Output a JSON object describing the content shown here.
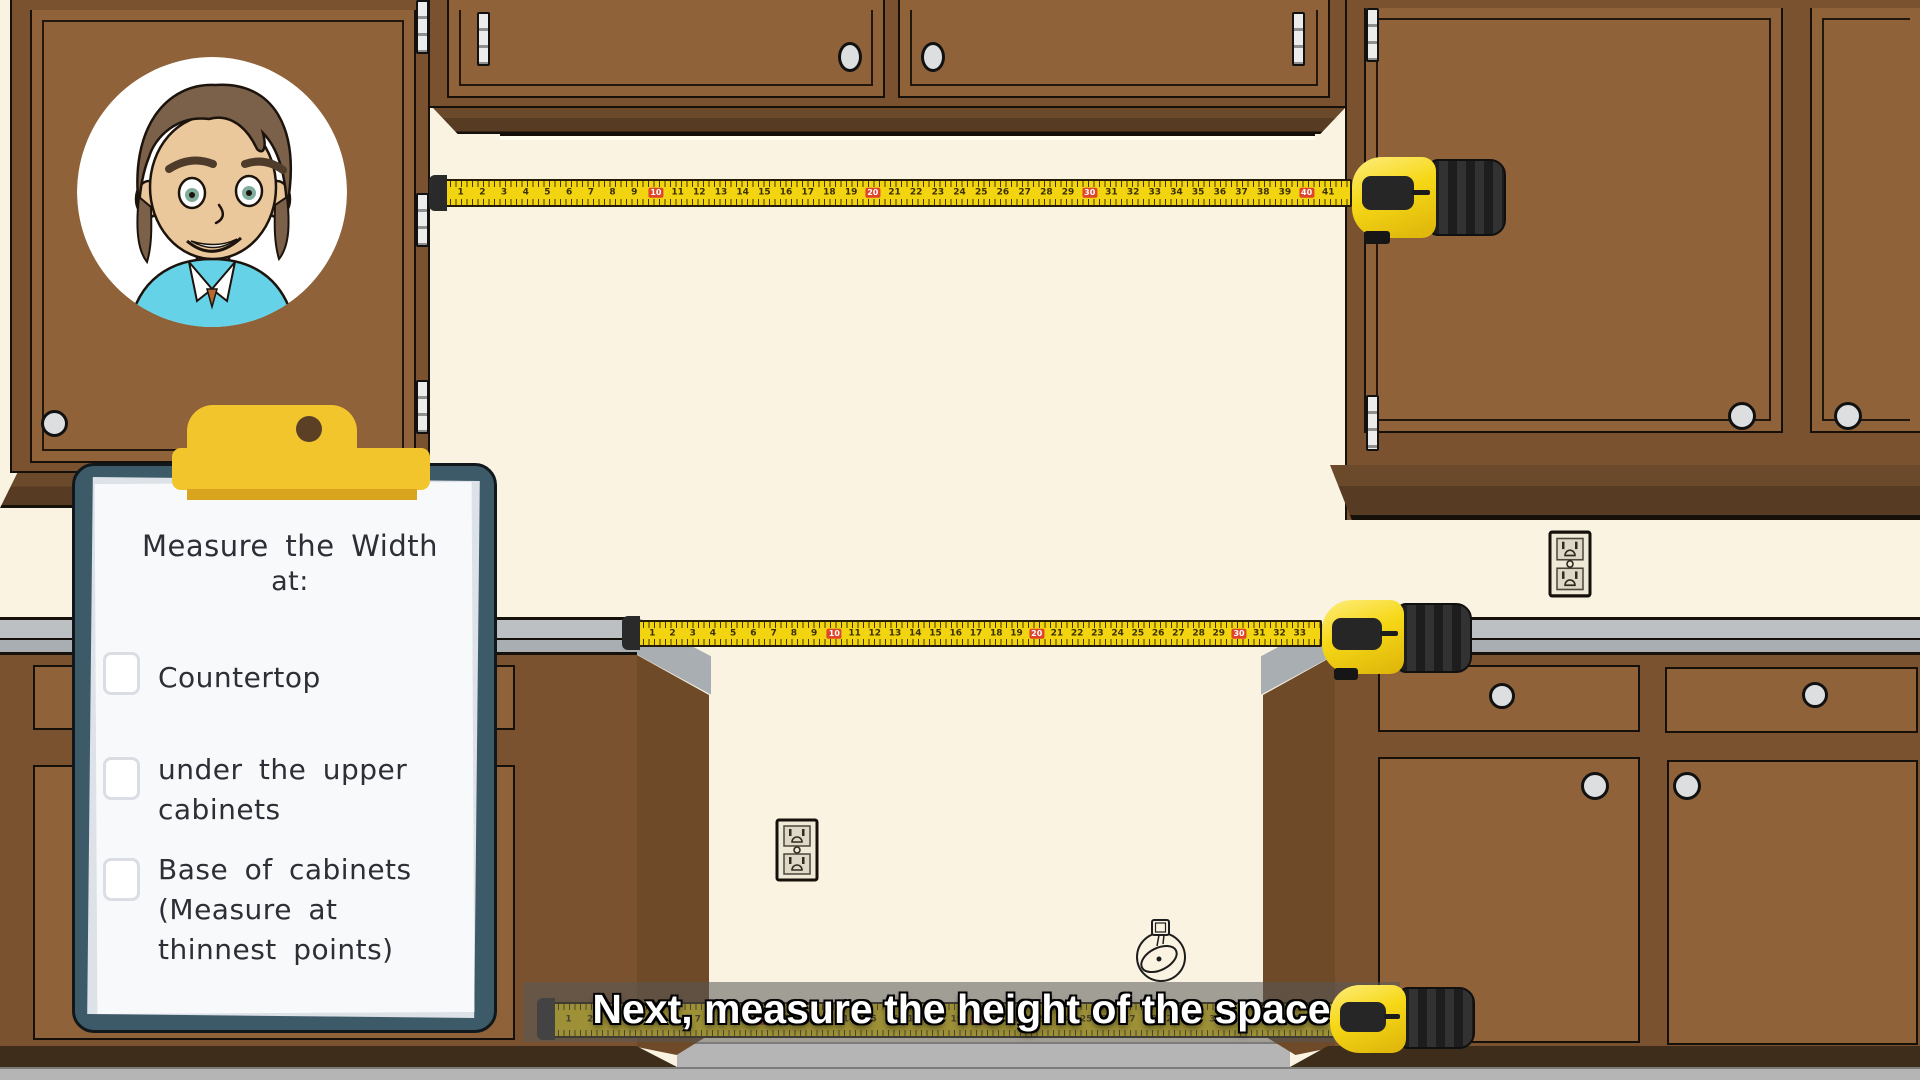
{
  "palette": {
    "wall": "#fbf3e2",
    "face": "#8f6239",
    "frame": "#7a5230",
    "trim1": "#6b4a2b",
    "trim2": "#573b22",
    "toe": "#3f2d1b",
    "ct_light": "#bcc0c3",
    "ct_mid": "#a9aeb2",
    "floor": "#b5b5b5",
    "outline": "#15100a",
    "clip_frame": "#3d5a68",
    "paper": "#f7f9fb",
    "clip_yellow": "#f3c52d",
    "clip_yellow_dark": "#daa51e",
    "tape_yellow": "#f2d411",
    "tape_red": "#e0442a",
    "body_yellow": "#f6d715",
    "body_black": "#262626",
    "ink": "#2e2e36"
  },
  "clipboard": {
    "title_line1": "Measure the Width",
    "title_line2": "at:",
    "items": [
      {
        "label": "Countertop",
        "checked": false
      },
      {
        "label": "under the upper\ncabinets",
        "checked": false
      },
      {
        "label": "Base of cabinets\n(Measure at\nthinnest points)",
        "checked": false
      }
    ]
  },
  "caption": {
    "text": "Next, measure the height of the space"
  },
  "tapes": [
    {
      "name": "upper-width-tape",
      "max_number": 41,
      "red_interval": 10
    },
    {
      "name": "countertop-width-tape",
      "max_number": 33,
      "red_interval": 10
    },
    {
      "name": "base-width-tape",
      "max_number": 38,
      "red_interval": 10
    }
  ],
  "icons": [
    "avatar-presenter",
    "wall-outlet",
    "tape-measure-doodle",
    "tape-measure-body"
  ]
}
